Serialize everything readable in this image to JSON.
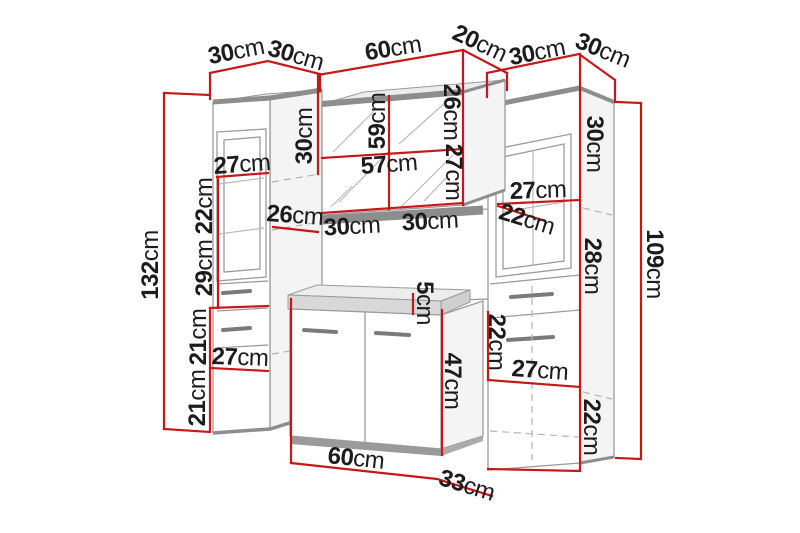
{
  "diagram": {
    "kind": "furniture-dimension-diagram",
    "background": "#ffffff",
    "unit": "cm"
  },
  "colors": {
    "dimension_line": "#c81717",
    "label_text": "#1c1c1c",
    "cabinet_outline": "#9b9b9b",
    "shadow": "#8d8d8d"
  },
  "sections": [
    {
      "name": "top-widths",
      "labels": [
        {
          "v": "30",
          "u": "cm",
          "x": 236,
          "y": 51,
          "r": -11
        },
        {
          "v": "30",
          "u": "cm",
          "x": 296,
          "y": 55,
          "r": 16
        },
        {
          "v": "60",
          "u": "cm",
          "x": 393,
          "y": 48,
          "r": -9
        },
        {
          "v": "20",
          "u": "cm",
          "x": 480,
          "y": 43,
          "r": 25
        },
        {
          "v": "30",
          "u": "cm",
          "x": 537,
          "y": 52,
          "r": -11
        },
        {
          "v": "30",
          "u": "cm",
          "x": 603,
          "y": 50,
          "r": 22
        }
      ]
    },
    {
      "name": "left-cabinet",
      "labels": [
        {
          "v": "132",
          "u": "cm",
          "x": 150,
          "y": 265,
          "r": -90
        },
        {
          "v": "27",
          "u": "cm",
          "x": 242,
          "y": 164,
          "r": -4
        },
        {
          "v": "22",
          "u": "cm",
          "x": 204,
          "y": 206,
          "r": -90
        },
        {
          "v": "29",
          "u": "cm",
          "x": 204,
          "y": 268,
          "r": -90
        },
        {
          "v": "26",
          "u": "cm",
          "x": 295,
          "y": 215,
          "r": 4
        },
        {
          "v": "21",
          "u": "cm",
          "x": 198,
          "y": 337,
          "r": -90
        },
        {
          "v": "27",
          "u": "cm",
          "x": 240,
          "y": 357,
          "r": 2
        },
        {
          "v": "21",
          "u": "cm",
          "x": 197,
          "y": 398,
          "r": -90
        }
      ]
    },
    {
      "name": "mirror-cabinet",
      "labels": [
        {
          "v": "30",
          "u": "cm",
          "x": 304,
          "y": 136,
          "r": -90
        },
        {
          "v": "59",
          "u": "cm",
          "x": 377,
          "y": 121,
          "r": -90
        },
        {
          "v": "26",
          "u": "cm",
          "x": 452,
          "y": 112,
          "r": 90
        },
        {
          "v": "57",
          "u": "cm",
          "x": 389,
          "y": 164,
          "r": -4
        },
        {
          "v": "27",
          "u": "cm",
          "x": 454,
          "y": 172,
          "r": 90
        },
        {
          "v": "30",
          "u": "cm",
          "x": 352,
          "y": 226,
          "r": -3
        },
        {
          "v": "30",
          "u": "cm",
          "x": 430,
          "y": 221,
          "r": -3
        }
      ]
    },
    {
      "name": "right-cabinet",
      "labels": [
        {
          "v": "109",
          "u": "cm",
          "x": 655,
          "y": 264,
          "r": 90
        },
        {
          "v": "30",
          "u": "cm",
          "x": 595,
          "y": 144,
          "r": 90
        },
        {
          "v": "27",
          "u": "cm",
          "x": 538,
          "y": 190,
          "r": -2
        },
        {
          "v": "22",
          "u": "cm",
          "x": 527,
          "y": 219,
          "r": 17
        },
        {
          "v": "28",
          "u": "cm",
          "x": 593,
          "y": 266,
          "r": 90
        },
        {
          "v": "22",
          "u": "cm",
          "x": 497,
          "y": 342,
          "r": 90
        },
        {
          "v": "27",
          "u": "cm",
          "x": 540,
          "y": 370,
          "r": 4
        },
        {
          "v": "22",
          "u": "cm",
          "x": 592,
          "y": 427,
          "r": 90
        }
      ]
    },
    {
      "name": "sink-cabinet",
      "labels": [
        {
          "v": "5",
          "u": "cm",
          "x": 425,
          "y": 303,
          "r": 90,
          "s": 22
        },
        {
          "v": "47",
          "u": "cm",
          "x": 453,
          "y": 381,
          "r": 90
        },
        {
          "v": "60",
          "u": "cm",
          "x": 356,
          "y": 458,
          "r": 6
        },
        {
          "v": "33",
          "u": "cm",
          "x": 467,
          "y": 485,
          "r": 17
        }
      ]
    }
  ]
}
